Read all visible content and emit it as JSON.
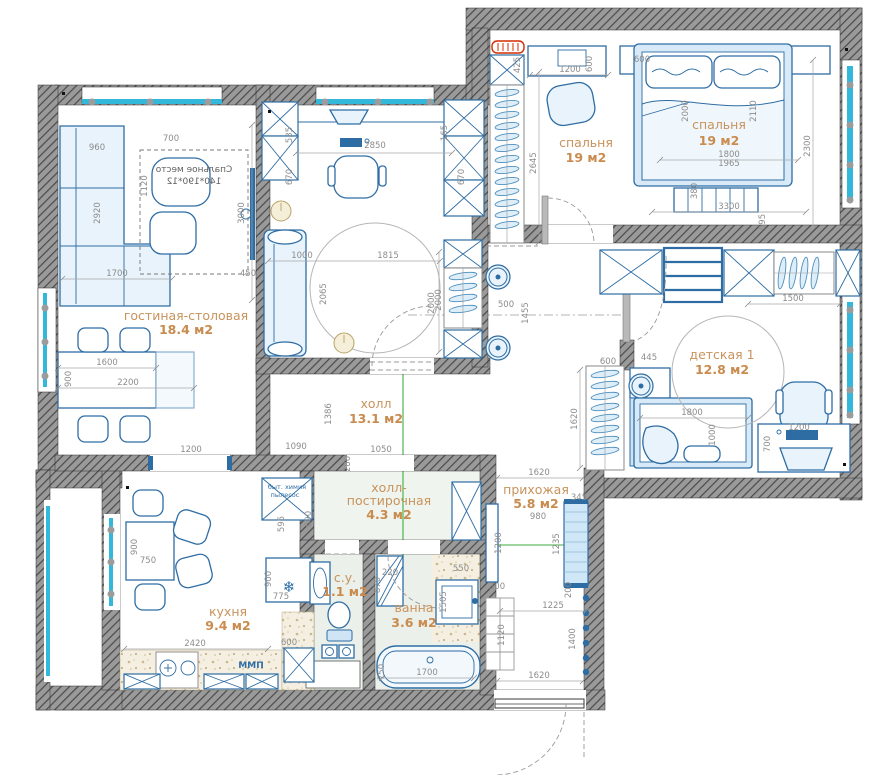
{
  "plan_type": "apartment-floor-plan",
  "colors": {
    "wall": "#8f8f8f",
    "wall_hatch": "#4a4a4a",
    "furniture": "#2e6da4",
    "furniture_fill": "#e8f3fb",
    "window": "#33b7da",
    "dimension_text": "#8c8c8c",
    "room_label": "#c8935c",
    "guide_line": "#3fae3f",
    "radiator": "#d42b00"
  },
  "rooms": [
    {
      "name": "гостиная-столовая",
      "area": "18.4 м2"
    },
    {
      "name": "спальня",
      "area": "19 м2"
    },
    {
      "name": "детская 1",
      "area": "12.8 м2"
    },
    {
      "name": "холл",
      "area": "13.1 м2"
    },
    {
      "name": "холл-",
      "name2": "постирочная",
      "area": "4.3 м2"
    },
    {
      "name": "прихожая",
      "area": "5.8 м2"
    },
    {
      "name": "кухня",
      "area": "9.4 м2"
    },
    {
      "name": "с.у.",
      "area": "1.1 м2"
    },
    {
      "name": "ванна",
      "area": "3.6 м2"
    }
  ],
  "annotations": {
    "sleeping_line1": "Спальное место",
    "sleeping_line2": "140*190*12",
    "storage_line1": "быт. химия",
    "storage_line2": "пылесос",
    "dishwasher": "ПММ"
  },
  "icons": {
    "snowflake": "❄"
  },
  "dims": [
    "960",
    "700",
    "1120",
    "2920",
    "3000",
    "1700",
    "450",
    "1600",
    "2200",
    "900",
    "1200",
    "535",
    "670",
    "2850",
    "1000",
    "1815",
    "2065",
    "2000",
    "165",
    "670",
    "1090",
    "280",
    "1050",
    "1386",
    "425",
    "1200",
    "600",
    "600",
    "2645",
    "2000",
    "2110",
    "1800",
    "1965",
    "2300",
    "380",
    "3300",
    "695",
    "2000",
    "500",
    "1455",
    "1500",
    "600",
    "445",
    "1620",
    "1800",
    "1000",
    "1200",
    "700",
    "1620",
    "345",
    "980",
    "1200",
    "1235",
    "300",
    "200",
    "1225",
    "1120",
    "1400",
    "1620",
    "900",
    "750",
    "2420",
    "775",
    "900",
    "595",
    "690",
    "600",
    "220",
    "870",
    "1505",
    "550",
    "750",
    "1700"
  ]
}
